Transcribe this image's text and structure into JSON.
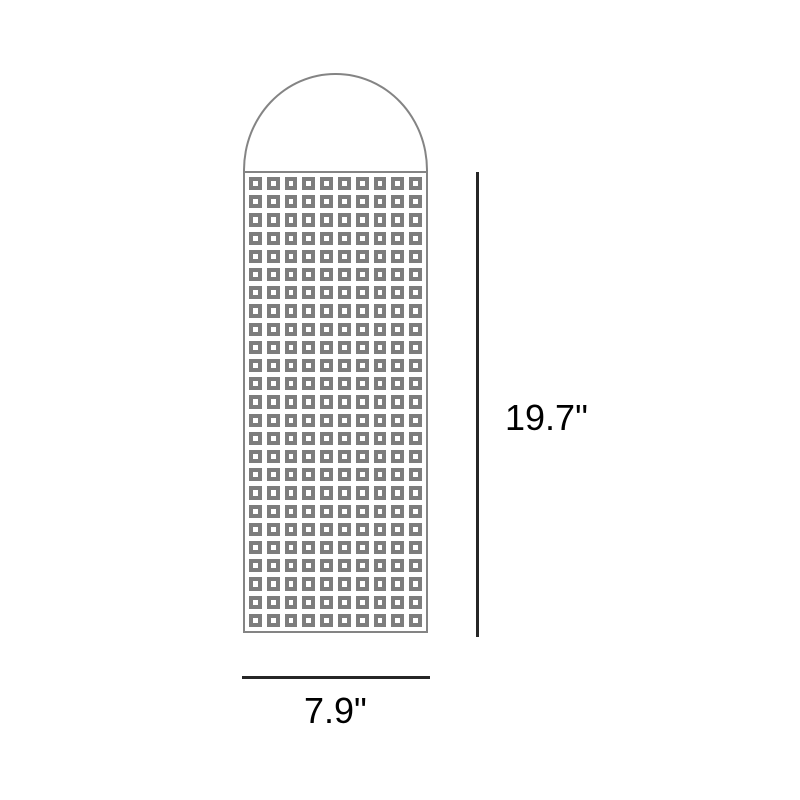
{
  "diagram": {
    "type": "product-dimension-drawing",
    "height_label": "19.7\"",
    "width_label": "7.9\"",
    "grid": {
      "rows": 25,
      "cols": 10
    },
    "colors": {
      "background": "#ffffff",
      "figure_stroke": "#848484",
      "cell_gray": "#7d7d7d",
      "dimension_line": "#262626",
      "label_text": "#000000"
    }
  }
}
